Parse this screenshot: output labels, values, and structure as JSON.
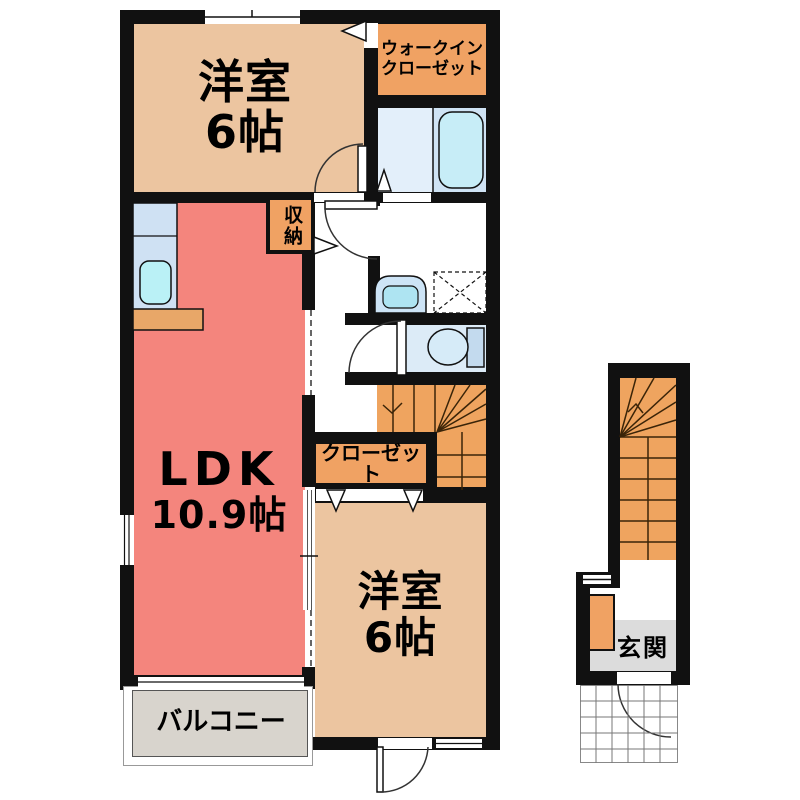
{
  "labels": {
    "bedroom_top": {
      "name": "洋室",
      "size": "6帖"
    },
    "wic": {
      "line1": "ウォークイン",
      "line2": "クローゼット"
    },
    "ldk": {
      "name": "LDK",
      "size": "10.9帖"
    },
    "storage": {
      "text": "収納"
    },
    "closet": {
      "text": "クローゼット"
    },
    "bedroom_bottom": {
      "name": "洋室",
      "size": "6帖"
    },
    "balcony": {
      "text": "バルコニー"
    },
    "entrance": {
      "text": "玄関"
    }
  },
  "colors": {
    "wall": "#111111",
    "room-peach": "#ecc5a0",
    "closet-orange": "#f0a263",
    "stairs-orange": "#efa45f",
    "ldk-salmon": "#f4857d",
    "balcony-gray": "#d8d4cd",
    "entrance-gray": "#dcdcdc",
    "bath-left": "#e3effa",
    "bath-right": "#cfe3f4",
    "bathtub": "#c7edf7",
    "kitchen-counter": "#cfe1f3",
    "sink-cyan": "#baf1f6",
    "counter-orange": "#e8a768",
    "washbasin-outer": "#cde4f6",
    "washbasin-inner": "#aee4f2",
    "toilet-room": "#dcebf7"
  }
}
